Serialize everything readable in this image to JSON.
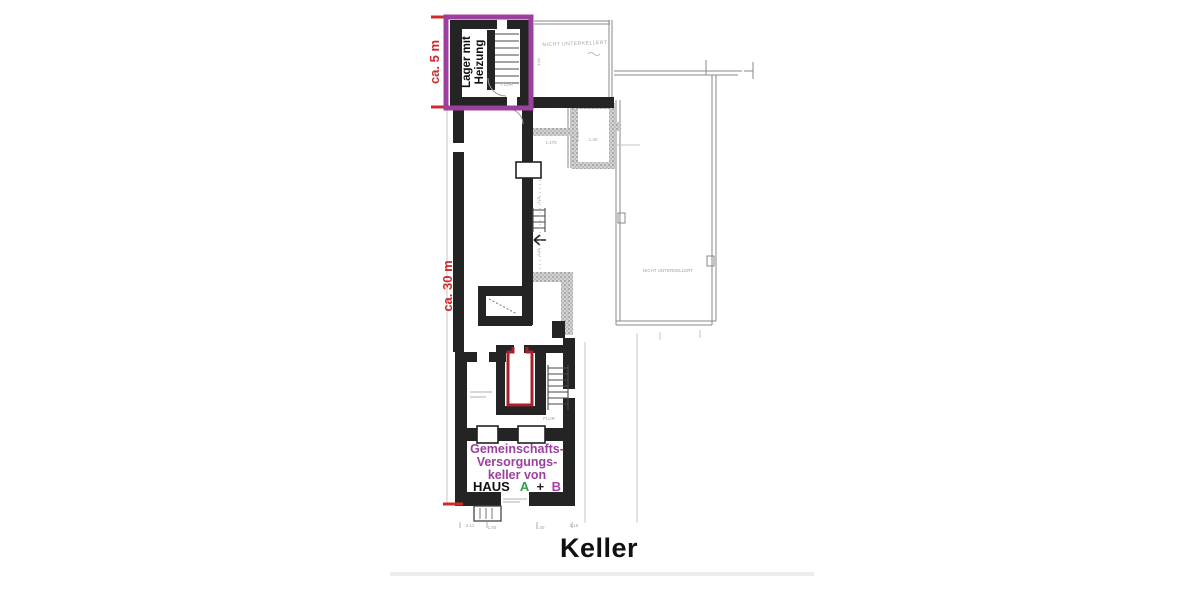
{
  "title": {
    "text": "Keller"
  },
  "colors": {
    "highlight_purple": "#9c3f9f",
    "dimension_red": "#cf2b2b",
    "room_outline_red": "#a8202a",
    "haus_a_green": "#2fa148",
    "haus_b_purple": "#a83fa8",
    "wall_black": "#242424",
    "pencil_gray": "#8a8a8a",
    "faint_gray": "#a2a2a2"
  },
  "highlight_box": {
    "room_label_line1": "Lager mit",
    "room_label_line2": "Heizung",
    "width_dim": "ca. 5 m"
  },
  "corridor": {
    "length_dim": "ca. 30 m"
  },
  "community_room": {
    "line1": "Gemeinschafts-",
    "line2": "Versorgungs-",
    "line3": "keller von",
    "haus": "HAUS",
    "unit_a": "A",
    "plus": "+",
    "unit_b": "B"
  },
  "faint": {
    "nicht_top": "NICHT UNTERKELLERT",
    "nicht_right": "NICHT UNTERKELLERT",
    "flur_top": "FLUR",
    "flur_bottom": "FLUR",
    "dim_1475": "1.475",
    "dim_140": "1.40",
    "dim_2465": "2.465",
    "dim_480": "4.80",
    "dim_101": "1.01",
    "dim_485": "4.85",
    "brow_1": "1.11",
    "brow_2": "1.93",
    "brow_3": "1.40",
    "brow_4": "1.18"
  }
}
